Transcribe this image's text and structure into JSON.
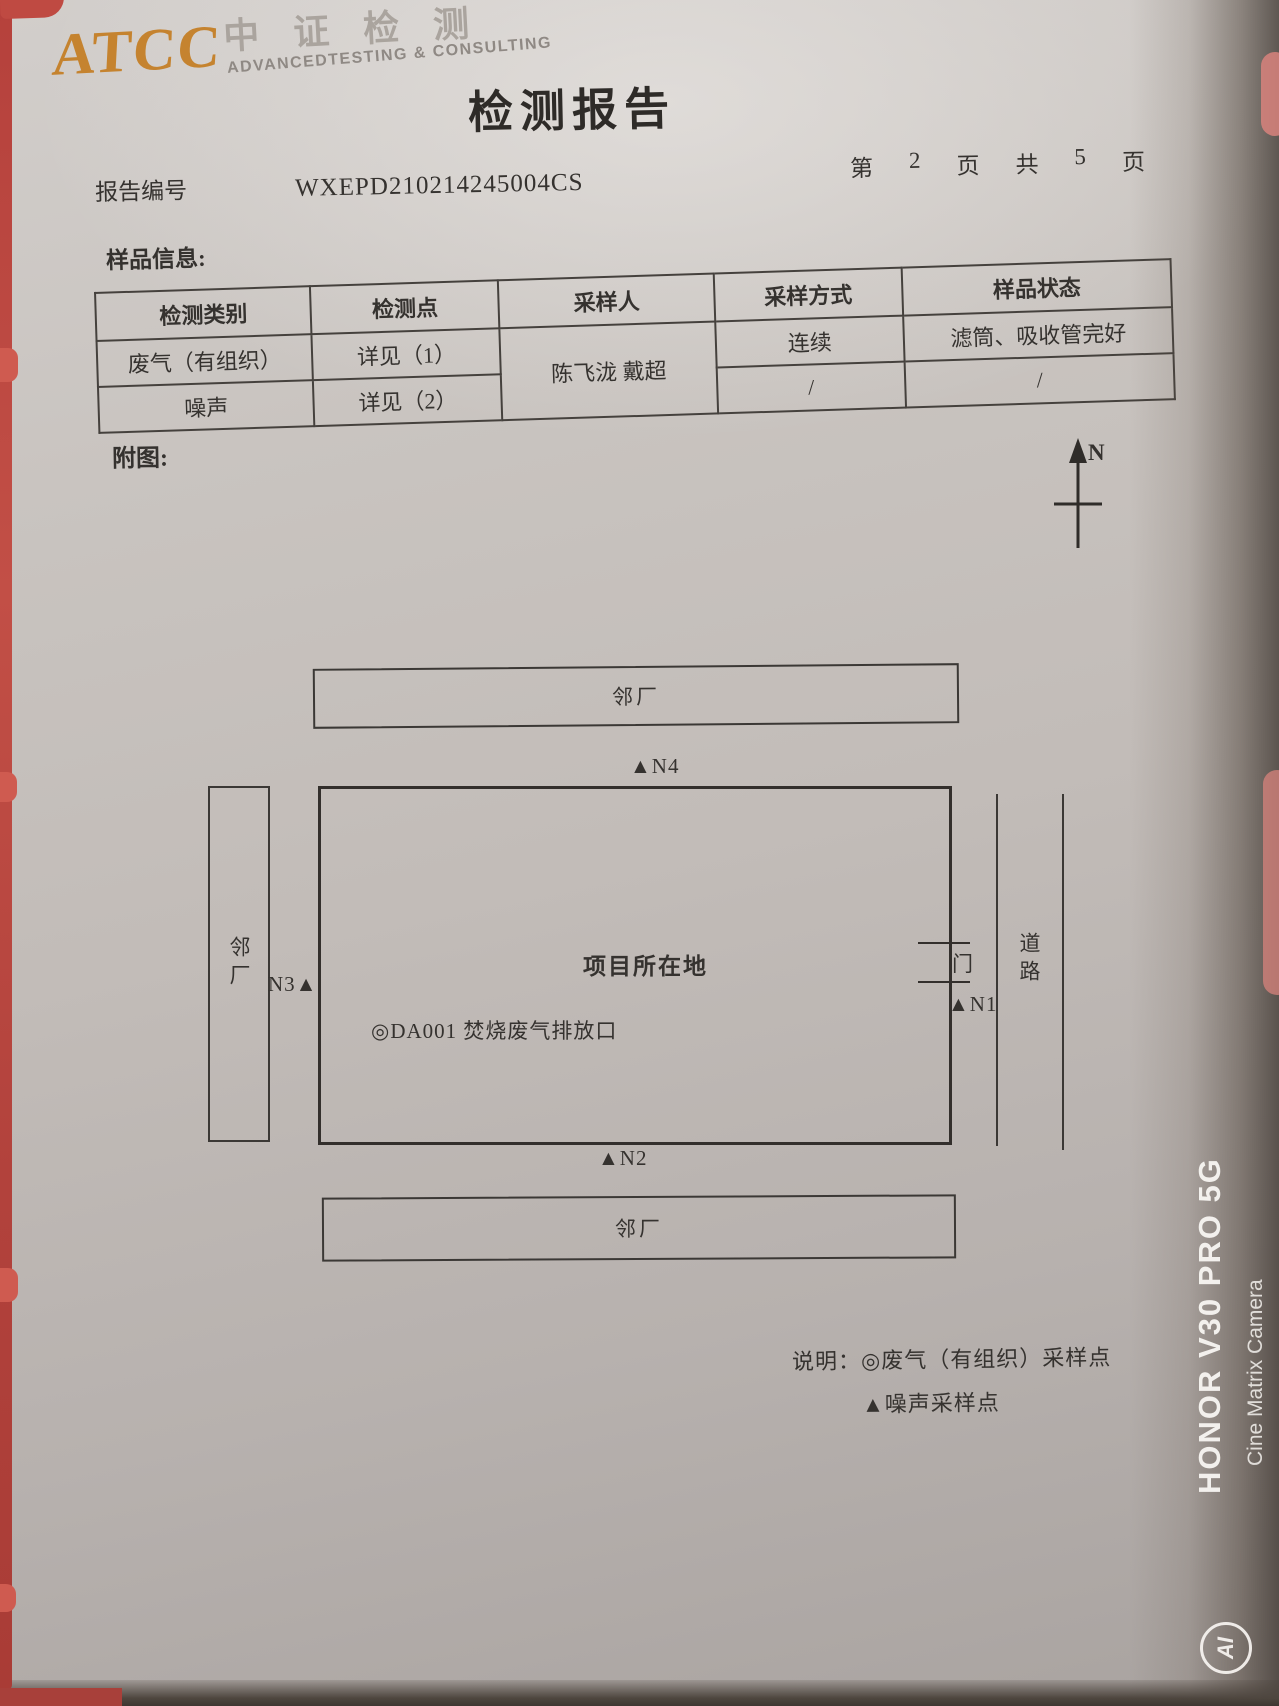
{
  "photo": {
    "edge_red": "#bf4a42",
    "shade_dark": "#4e463f",
    "watermark": {
      "line1": "HONOR V30 PRO 5G",
      "line2": "Cine Matrix Camera",
      "ai_label": "AI"
    }
  },
  "header": {
    "logo": {
      "acronym": "ATCC",
      "cn": "中证检测",
      "en": "ADVANCEDTESTING & CONSULTING",
      "accent_color": "#c5832f"
    },
    "title": "检测报告",
    "report_no_label": "报告编号",
    "report_no": "WXEPD210214245004CS",
    "page_info": [
      "第",
      "2",
      "页",
      "共",
      "5",
      "页"
    ]
  },
  "sample_info": {
    "section_label": "样品信息:",
    "columns": [
      "检测类别",
      "检测点",
      "采样人",
      "采样方式",
      "样品状态"
    ],
    "rows": [
      {
        "category": "废气（有组织）",
        "point": "详见（1）",
        "sampler": "陈飞泷 戴超",
        "method": "连续",
        "status": "滤筒、吸收管完好"
      },
      {
        "category": "噪声",
        "point": "详见（2）",
        "method": "/",
        "status": "/"
      }
    ]
  },
  "diagram": {
    "section_label": "附图:",
    "compass_label": "N",
    "north_factory": "邻厂",
    "west_factory": "邻厂",
    "south_factory": "邻厂",
    "site_label": "项目所在地",
    "emission_point": "◎DA001 焚烧废气排放口",
    "gate_label": "门",
    "road_label": "道路",
    "markers": {
      "n1": "▲N1",
      "n2": "▲N2",
      "n3": "N3▲",
      "n4": "▲N4"
    },
    "legend": {
      "title": "说明：",
      "gas": "◎废气（有组织）采样点",
      "noise": "▲噪声采样点"
    }
  }
}
